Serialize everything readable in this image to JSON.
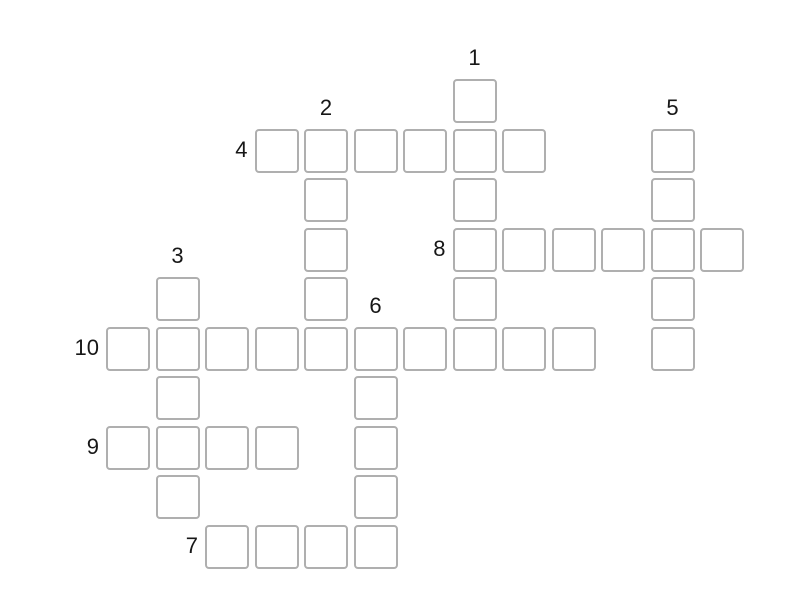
{
  "puzzle": {
    "background_color": "#ffffff",
    "cell": {
      "size": 44,
      "fill": "#ffffff",
      "border_color": "#afafaf",
      "border_width": 2,
      "corner_radius": 4
    },
    "grid": {
      "origin_x": 106,
      "origin_y": 79,
      "pitch": 49.5
    },
    "label_color": "#171717",
    "words": [
      {
        "number": "1",
        "direction": "down",
        "row": 0,
        "col": 7,
        "length": 6
      },
      {
        "number": "2",
        "direction": "down",
        "row": 1,
        "col": 4,
        "length": 5
      },
      {
        "number": "3",
        "direction": "down",
        "row": 4,
        "col": 1,
        "length": 5
      },
      {
        "number": "4",
        "direction": "across",
        "row": 1,
        "col": 3,
        "length": 6
      },
      {
        "number": "5",
        "direction": "down",
        "row": 1,
        "col": 11,
        "length": 5
      },
      {
        "number": "6",
        "direction": "down",
        "row": 5,
        "col": 5,
        "length": 5
      },
      {
        "number": "7",
        "direction": "across",
        "row": 9,
        "col": 2,
        "length": 4
      },
      {
        "number": "8",
        "direction": "across",
        "row": 3,
        "col": 7,
        "length": 6
      },
      {
        "number": "9",
        "direction": "across",
        "row": 7,
        "col": 0,
        "length": 4
      },
      {
        "number": "10",
        "direction": "across",
        "row": 5,
        "col": 0,
        "length": 10
      }
    ]
  }
}
